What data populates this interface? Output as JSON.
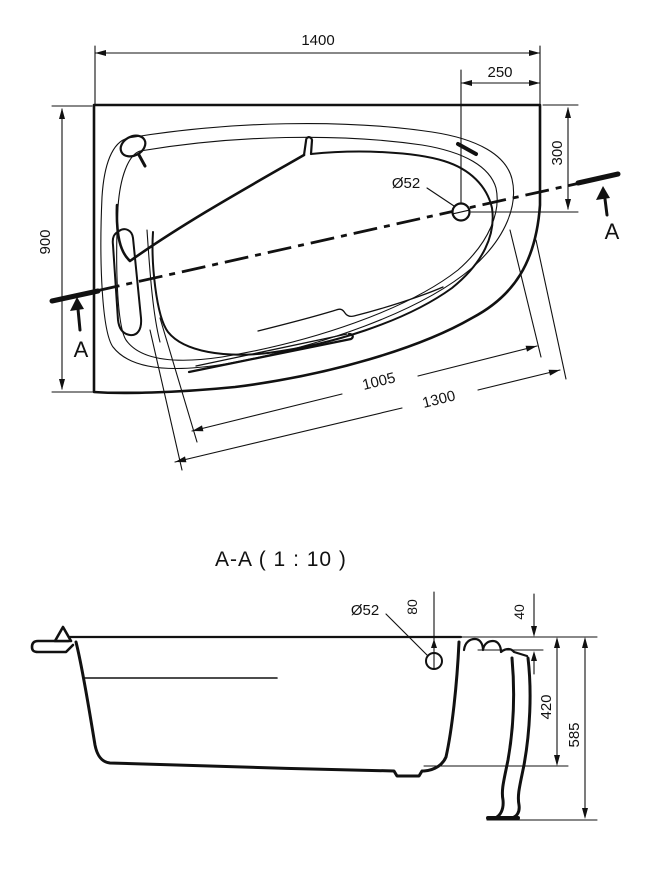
{
  "top_view": {
    "dim_overall_width": "1400",
    "dim_drain_offset_x": "250",
    "dim_drain_offset_y": "300",
    "dim_overall_depth": "900",
    "dim_inner_edge_length": "1005",
    "dim_outer_edge_length": "1300",
    "drain_diameter_label": "Ø52",
    "section_marker_left": "A",
    "section_marker_right": "A"
  },
  "section_view": {
    "title": "A-A ( 1 : 10 )",
    "drain_diameter_label": "Ø52",
    "dim_drain_center_to_rim": "80",
    "dim_rim_lip": "40",
    "dim_shell_height": "420",
    "dim_total_height": "585"
  },
  "style": {
    "line_color": "#111111",
    "background": "#ffffff"
  }
}
